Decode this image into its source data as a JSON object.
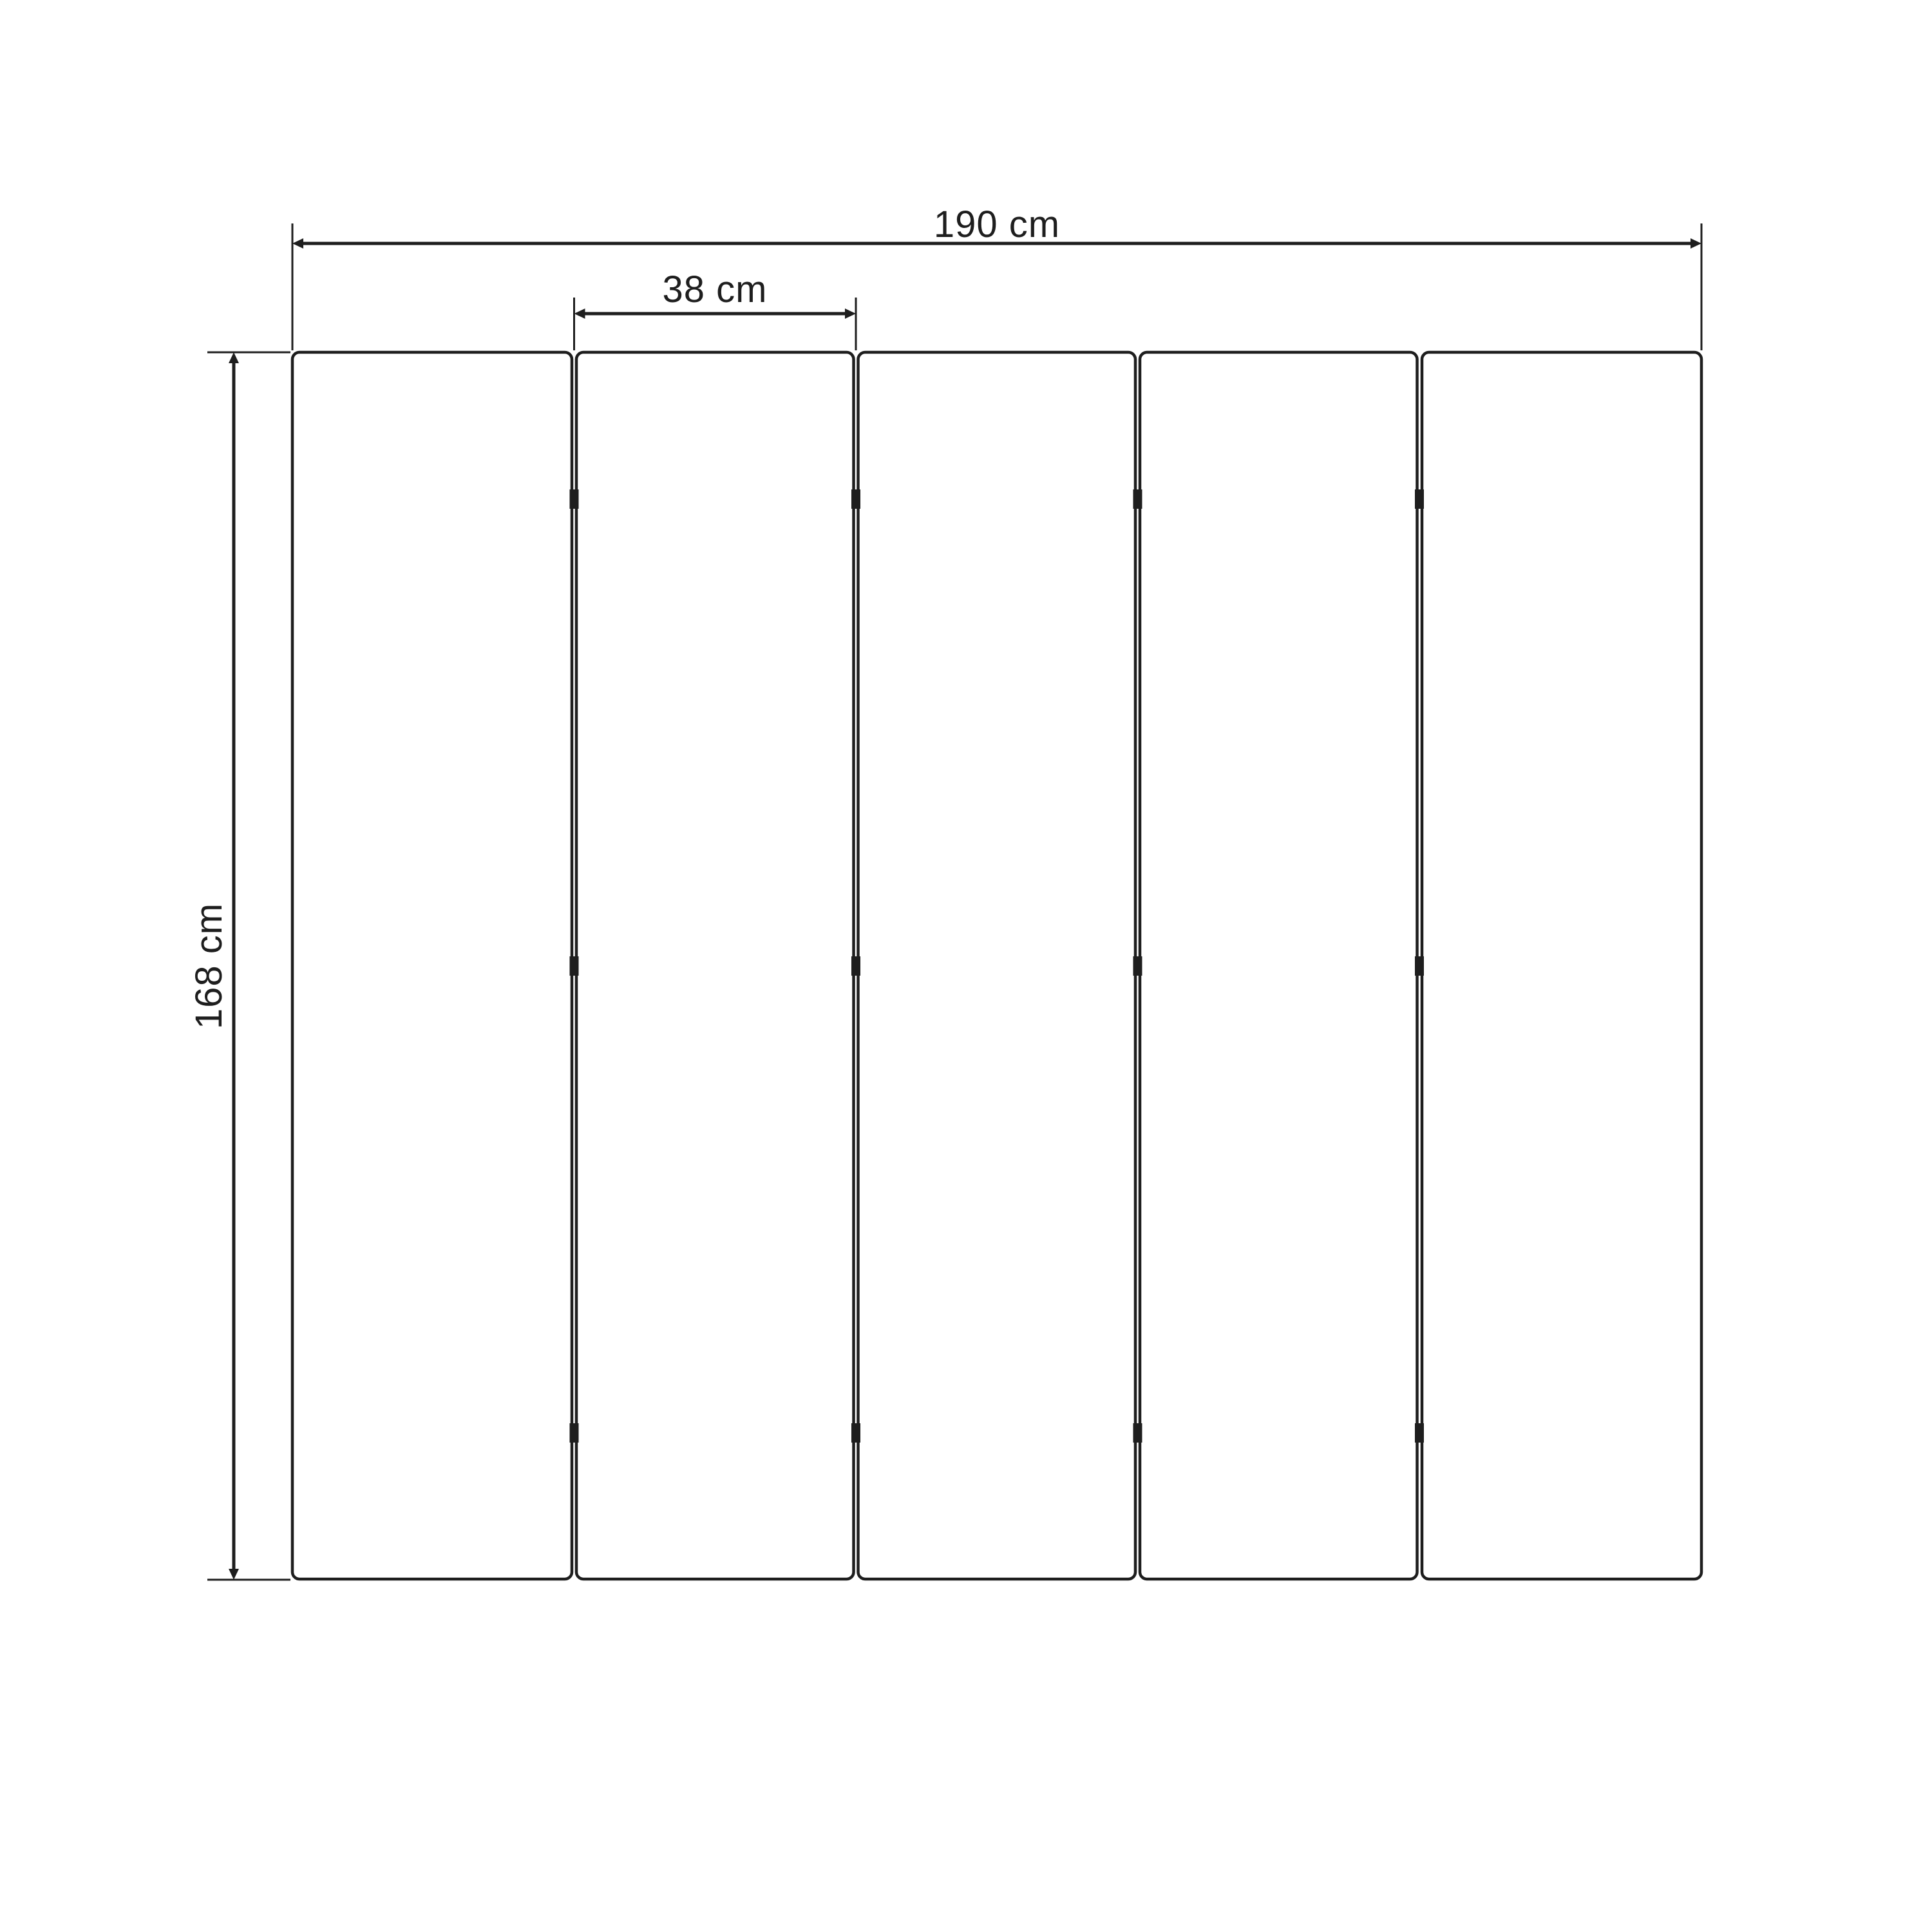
{
  "diagram": {
    "type": "product-dimension-diagram",
    "background_color": "#ffffff",
    "line_color": "#1e1e1e",
    "panels": {
      "count": 5,
      "gaps": 4,
      "hinge_rows_per_gap": 3
    },
    "dimensions": {
      "total_width": {
        "label": "190 cm"
      },
      "panel_width": {
        "label": "38 cm"
      },
      "height": {
        "label": "168 cm"
      }
    }
  }
}
